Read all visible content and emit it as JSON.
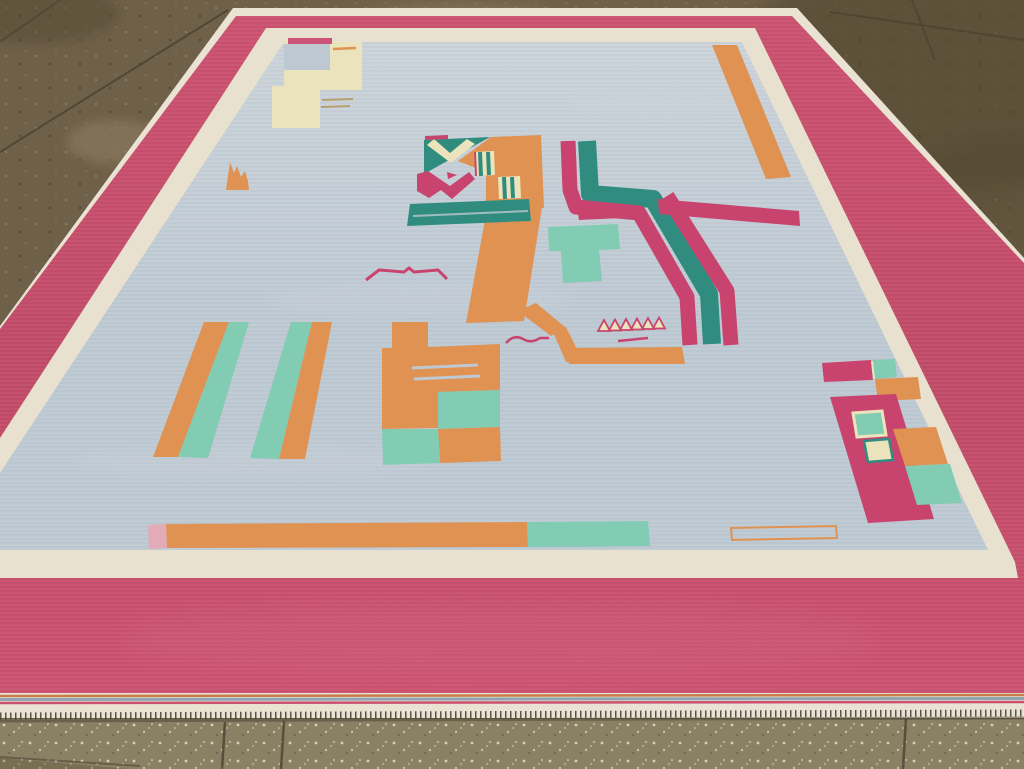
{
  "scene": {
    "title": "Mid-20th century Indian flat-weave dhurrie rug with rose-pink border and pale blue field, photographed on a concrete showroom floor",
    "setting": "large rug laid on speckled concrete tile floor, photographed in perspective",
    "rug": {
      "type": "flat-weave dhurrie, art-deco geometric design",
      "border": "wide rose-pink outer border with cream guard stripe framing the field",
      "field": "pale blue-grey ground",
      "edge_finish": "striped end band, cream selvedge and short dark fringe at the bottom edge",
      "motifs": [
        {
          "name": "cream-step-block",
          "desc": "stepped cream block in upper-left field with small pink strip and dashes"
        },
        {
          "name": "orange-diagonal-bar",
          "desc": "orange bar parallel to upper-right border"
        },
        {
          "name": "central-figure",
          "desc": "teal/cream/orange block motif with striped squares, pink M mark, teal cross-bar and orange column with hook"
        },
        {
          "name": "zigzag-band",
          "desc": "pink-teal-pink Z-shaped band on right half"
        },
        {
          "name": "diagonal-stripe-pairs",
          "desc": "two pairs of orange and mint stripes, lower left"
        },
        {
          "name": "checkerboard-block",
          "desc": "orange block with mint checker squares and thin blue lines"
        },
        {
          "name": "right-edge-cluster",
          "desc": "pink column with inset squares, orange and mint squares at right border"
        },
        {
          "name": "bottom-band",
          "desc": "pale pink, orange and mint strip along bottom of field"
        },
        {
          "name": "small-marks",
          "desc": "orange comb, pink bird line, wavy pink lines, outlined triangles and rectangle"
        }
      ]
    }
  },
  "palette": {
    "floor_top": "#6f6049",
    "floor_top_dark": "#50452f",
    "floor_light_patch": "#8d7d62",
    "floor_joint": "#463d2e",
    "floor_bottom": "#8a8164",
    "rug_edge_white": "#eae3d3",
    "border_pink": "#cb5170",
    "border_pink_deep": "#c04a67",
    "border_pink_light": "#d96f8b",
    "inner_border_cream": "#e8e1cf",
    "field_blue": "#bdc8d2",
    "field_blue_light": "#cbd3d9",
    "motif_orange": "#e09253",
    "motif_teal_dark": "#318c80",
    "motif_teal_mint": "#82ccb3",
    "motif_pink": "#c8446e",
    "motif_pink_pale": "#e3abb8",
    "motif_cream": "#ebe3bb",
    "motif_tan": "#b99f6f",
    "fringe_dark": "#3e3a2f",
    "stripe_blue": "#8fa5b4",
    "stripe_orange": "#c87c4a",
    "shadow": "#4a4236"
  }
}
